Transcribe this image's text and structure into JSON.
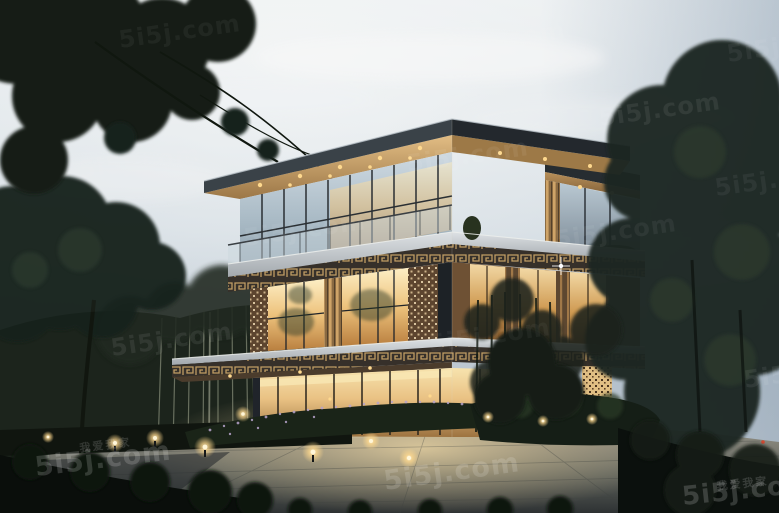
{
  "photo": {
    "subject": "Three-storey modern villa with stacked overhanging flat roofs, warm-lit glass walls, bronze fretwork bands and timber slat screens",
    "setting": "Dusk scene with landscaped garden, bamboo grove, mature trees, stone-paved plaza and warm bollard lights",
    "time_of_day": "dusk"
  },
  "watermark": {
    "site": "5i5j.com",
    "slogan": "我爱我家",
    "color": "#ffffff",
    "style": "semi-transparent tiled watermark"
  },
  "palette": {
    "sky_top": "#e8edf0",
    "sky_horizon": "#b7c3cd",
    "roof_fascia": "#2c3338",
    "soffit_wood": "#c79a5e",
    "window_warm": "#f2d296",
    "glass_cool": "#b7c6d1",
    "fretwork_bronze": "#bf9c63",
    "lattice_panel": "#6b4f36",
    "foliage": "#17211a",
    "plaza_stone": "#a39c8b",
    "garden_light_glow": "#ffd98e"
  }
}
